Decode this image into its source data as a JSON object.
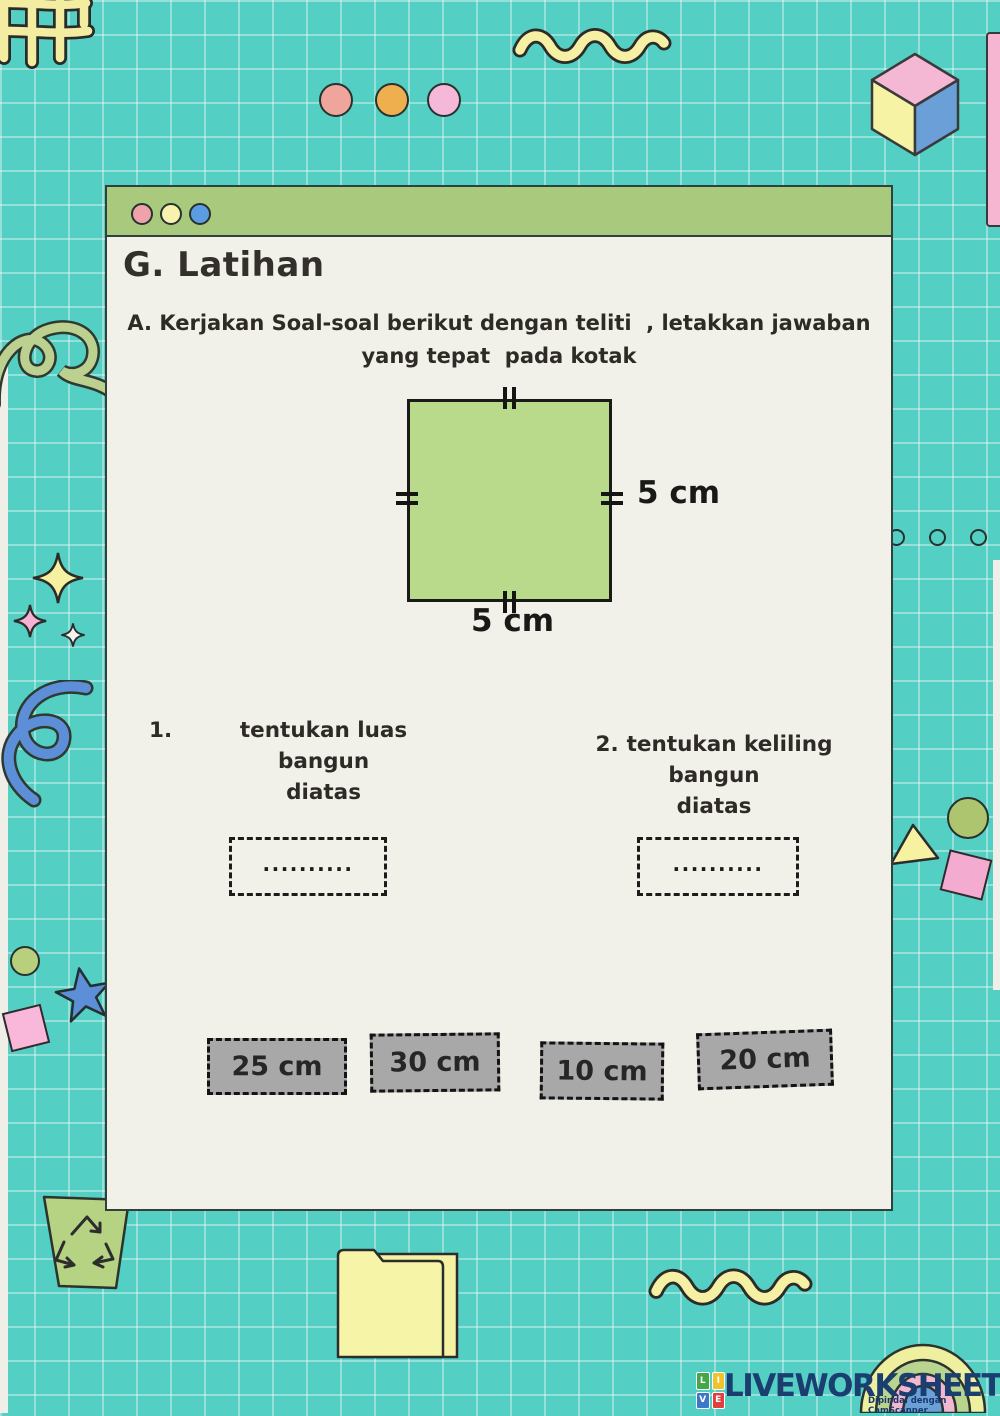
{
  "window": {
    "controls": [
      "pink-dot",
      "yellow-dot",
      "blue-dot"
    ],
    "title": "G. Latihan"
  },
  "instructions": {
    "line1": "A. Kerjakan Soal-soal berikut dengan teliti  , letakkan jawaban",
    "line2": "yang tepat  pada kotak"
  },
  "figure": {
    "shape": "square",
    "right_label": "5 cm",
    "bottom_label": "5 cm"
  },
  "questions": [
    {
      "number": "1.",
      "line1": "tentukan luas bangun",
      "line2": "diatas",
      "answer_placeholder": ".........."
    },
    {
      "number": "2.",
      "line1": "tentukan keliling bangun",
      "line2": "diatas",
      "answer_placeholder": ".........."
    }
  ],
  "answer_options": [
    {
      "label": "25 cm"
    },
    {
      "label": "30 cm"
    },
    {
      "label": "10 cm"
    },
    {
      "label": "20 cm"
    }
  ],
  "branding": {
    "logo_letters": [
      "L",
      "I",
      "V",
      "E"
    ],
    "logo_text": "LIVEWORKSHEETS",
    "watermark": "Dipindai dengan CamScanner"
  },
  "colors": {
    "background": "#54cfc4",
    "card": "#f1f0e9",
    "header": "#a9ca7c",
    "square_fill": "#b9d98b",
    "option_fill": "#a8a8a8",
    "logo_navy": "#1b3e70"
  }
}
